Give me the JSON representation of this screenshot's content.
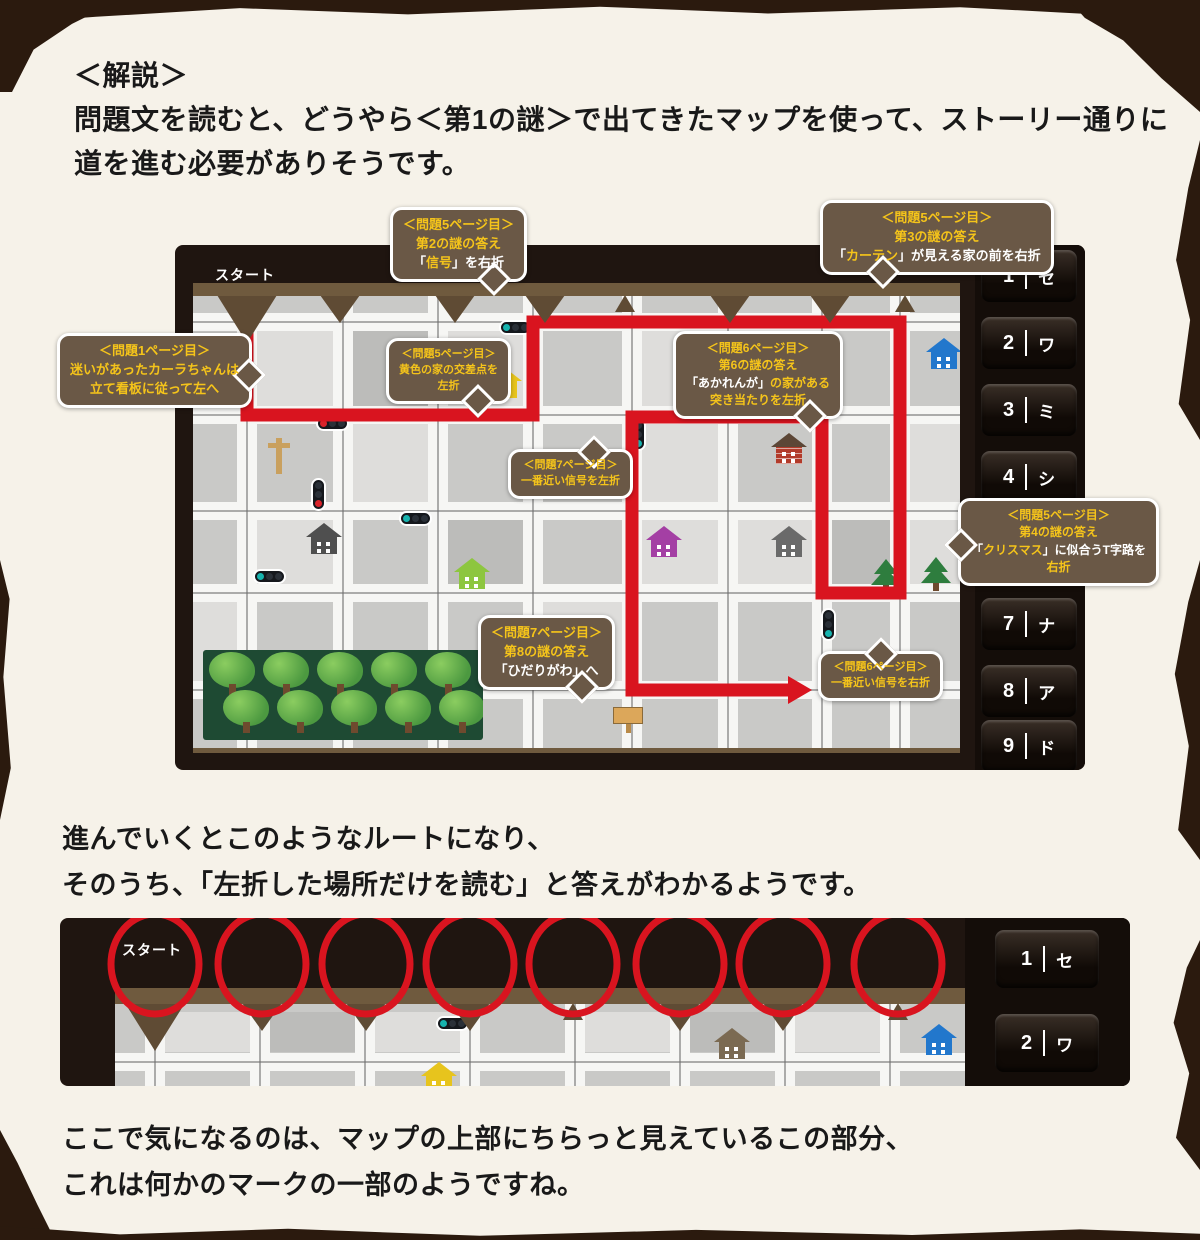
{
  "intro": {
    "heading": "＜解説＞",
    "line1": "問題文を読むと、どうやら＜第1の謎＞で出てきたマップを使って、ストーリー通りに",
    "line2": "道を進む必要がありそうです。"
  },
  "mid": {
    "line1": "進んでいくとこのようなルートになり、",
    "line2": "そのうち、「左折した場所だけを読む」と答えがわかるようです。"
  },
  "outro": {
    "line1": "ここで気になるのは、マップの上部にちらっと見えているこの部分、",
    "line2": "これは何かのマークの一部のようですね。"
  },
  "colors": {
    "accent_red": "#d9141f",
    "bubble_bg": "#6a5846",
    "bubble_yellow": "#f5c41a",
    "paper": "#f6f2e9",
    "frame": "#1f1510",
    "strip": "#6f5a3e",
    "map_base": "#c9c9c7",
    "road": "#f6f6f4",
    "teal": "#17b3ae",
    "signal_red": "#d8232a",
    "signal_off": "#2a3038"
  },
  "map1": {
    "x": 175,
    "y": 245,
    "w": 910,
    "h": 525,
    "inner": {
      "x": 18,
      "y": 51,
      "w": 767,
      "h": 452
    },
    "strip_h": 13,
    "start_label": "スタート",
    "start_pos": [
      40,
      20
    ],
    "notches": [
      {
        "x": 54,
        "t": "vbig"
      },
      {
        "x": 147,
        "t": "v"
      },
      {
        "x": 262,
        "t": "v"
      },
      {
        "x": 352,
        "t": "v"
      },
      {
        "x": 432,
        "t": "a"
      },
      {
        "x": 537,
        "t": "v"
      },
      {
        "x": 637,
        "t": "v"
      },
      {
        "x": 712,
        "t": "a"
      }
    ],
    "grid_x": [
      54,
      150,
      245,
      340,
      439,
      535,
      629,
      707
    ],
    "grid_y": [
      26,
      119,
      215,
      297,
      394
    ],
    "blocks_light": [
      [
        64,
        35,
        76,
        75
      ],
      [
        255,
        35,
        75,
        75
      ],
      [
        449,
        35,
        86,
        75
      ],
      [
        160,
        128,
        75,
        78
      ],
      [
        449,
        128,
        86,
        160
      ],
      [
        64,
        224,
        96,
        64
      ],
      [
        350,
        306,
        79,
        79
      ],
      [
        545,
        224,
        74,
        64
      ],
      [
        717,
        128,
        50,
        160
      ],
      [
        0,
        306,
        44,
        80
      ]
    ],
    "blocks_dark": [
      [
        160,
        35,
        75,
        75
      ],
      [
        639,
        224,
        58,
        64
      ],
      [
        255,
        224,
        75,
        64
      ]
    ],
    "route": {
      "points": [
        [
          54,
          11
        ],
        [
          54,
          119
        ],
        [
          340,
          119
        ],
        [
          340,
          26
        ],
        [
          707,
          26
        ],
        [
          707,
          297
        ],
        [
          629,
          297
        ],
        [
          629,
          121
        ],
        [
          439,
          121
        ],
        [
          439,
          394
        ],
        [
          597,
          394
        ]
      ],
      "width": 13
    },
    "icons": [
      {
        "t": "tlh",
        "x": 320,
        "y": 38,
        "d": [
          "teal",
          "off",
          "off"
        ]
      },
      {
        "t": "tlh",
        "x": 137,
        "y": 134,
        "d": [
          "red",
          "off",
          "off"
        ]
      },
      {
        "t": "tlv",
        "x": 132,
        "y": 196,
        "d": [
          "off",
          "off",
          "red"
        ]
      },
      {
        "t": "tlh",
        "x": 220,
        "y": 229,
        "d": [
          "teal",
          "off",
          "off"
        ]
      },
      {
        "t": "tlh",
        "x": 74,
        "y": 287,
        "d": [
          "teal",
          "off",
          "off"
        ]
      },
      {
        "t": "tlv",
        "x": 452,
        "y": 136,
        "d": [
          "off",
          "off",
          "teal"
        ]
      },
      {
        "t": "tlv",
        "x": 642,
        "y": 326,
        "d": [
          "off",
          "off",
          "teal"
        ]
      },
      {
        "t": "post",
        "x": 97,
        "y": 156
      },
      {
        "t": "house",
        "x": 307,
        "y": 85,
        "c": "#e7c41d"
      },
      {
        "t": "house",
        "x": 127,
        "y": 241,
        "c": "#4f4f4f"
      },
      {
        "t": "house",
        "x": 275,
        "y": 276,
        "c": "#8dc63f"
      },
      {
        "t": "house",
        "x": 467,
        "y": 244,
        "c": "#a43fa4"
      },
      {
        "t": "house",
        "x": 592,
        "y": 244,
        "c": "#6a6a6a"
      },
      {
        "t": "house",
        "x": 592,
        "y": 151,
        "c": "#b23b2a",
        "roof": "#5c4636",
        "brick": true
      },
      {
        "t": "house",
        "x": 747,
        "y": 56,
        "c": "#2277cc"
      },
      {
        "t": "pine",
        "x": 692,
        "y": 277
      },
      {
        "t": "pine",
        "x": 742,
        "y": 275
      },
      {
        "t": "deco",
        "x": 737,
        "y": 376
      },
      {
        "t": "board",
        "x": 434,
        "y": 425
      }
    ],
    "forest": {
      "x": 10,
      "y": 354,
      "w": 280,
      "h": 90
    },
    "keys_panel": {
      "x": 800,
      "w": 110,
      "key_x": 806,
      "key_w": 96,
      "key_h": 52
    },
    "keys": [
      {
        "n": "1",
        "k": "セ",
        "y": 5
      },
      {
        "n": "2",
        "k": "ワ",
        "y": 72
      },
      {
        "n": "3",
        "k": "ミ",
        "y": 139
      },
      {
        "n": "4",
        "k": "シ",
        "y": 206
      },
      {
        "n": "7",
        "k": "ナ",
        "y": 353
      },
      {
        "n": "8",
        "k": "ア",
        "y": 420
      },
      {
        "n": "9",
        "k": "ド",
        "y": 475
      }
    ]
  },
  "map2": {
    "x": 60,
    "y": 918,
    "w": 1070,
    "h": 168,
    "inner": {
      "x": 55,
      "y": 86,
      "w": 850,
      "h": 82
    },
    "strip_h": 16,
    "start_label": "スタート",
    "start_pos": [
      62,
      22
    ],
    "notches": [
      {
        "x": 40,
        "t": "vbig"
      },
      {
        "x": 147,
        "t": "v"
      },
      {
        "x": 251,
        "t": "v"
      },
      {
        "x": 355,
        "t": "v"
      },
      {
        "x": 458,
        "t": "a"
      },
      {
        "x": 565,
        "t": "v"
      },
      {
        "x": 668,
        "t": "v"
      },
      {
        "x": 783,
        "t": "a"
      }
    ],
    "grid_x": [
      40,
      145,
      250,
      355,
      460,
      565,
      670,
      775
    ],
    "grid_y": [
      58
    ],
    "blocks_light": [
      [
        50,
        8,
        85,
        40
      ],
      [
        260,
        8,
        85,
        40
      ],
      [
        470,
        8,
        85,
        40
      ],
      [
        680,
        8,
        85,
        40
      ]
    ],
    "blocks_dark": [
      [
        155,
        8,
        85,
        40
      ],
      [
        575,
        8,
        85,
        40
      ]
    ],
    "circles": {
      "cx": [
        95,
        202,
        306,
        410,
        513,
        620,
        723,
        838
      ],
      "cy": 46,
      "rx": 44,
      "ry": 50
    },
    "icons": [
      {
        "t": "tlh",
        "x": 335,
        "y": 26,
        "d": [
          "teal",
          "off",
          "off"
        ]
      },
      {
        "t": "house",
        "x": 613,
        "y": 38,
        "c": "#7b6a52"
      },
      {
        "t": "house",
        "x": 820,
        "y": 34,
        "c": "#2277cc"
      },
      {
        "t": "house",
        "x": 320,
        "y": 72,
        "c": "#e7c41d"
      }
    ],
    "keys_panel": {
      "x": 905,
      "w": 165,
      "key_x": 935,
      "key_w": 104,
      "key_h": 58
    },
    "keys": [
      {
        "n": "1",
        "k": "セ",
        "y": 12
      },
      {
        "n": "2",
        "k": "ワ",
        "y": 96
      }
    ]
  },
  "bubbles": [
    {
      "x": 390,
      "y": 207,
      "fs": 13,
      "tail": "t-br",
      "lines": [
        [
          {
            "t": "＜問題5ページ目＞",
            "c": "y"
          }
        ],
        [
          {
            "t": "第2の謎の答え",
            "c": "y"
          }
        ],
        [
          {
            "t": "「",
            "c": "w"
          },
          {
            "t": "信号",
            "c": "y"
          },
          {
            "t": "」を右折",
            "c": "w"
          }
        ]
      ]
    },
    {
      "x": 820,
      "y": 200,
      "fs": 13,
      "tail": "t-bl",
      "lines": [
        [
          {
            "t": "＜問題5ページ目＞",
            "c": "y"
          }
        ],
        [
          {
            "t": "第3の謎の答え",
            "c": "y"
          }
        ],
        [
          {
            "t": "「",
            "c": "w"
          },
          {
            "t": "カーテン",
            "c": "y"
          },
          {
            "t": "」が見える家の前を右折",
            "c": "w"
          }
        ]
      ]
    },
    {
      "x": 57,
      "y": 333,
      "fs": 13,
      "tail": "t-r",
      "lines": [
        [
          {
            "t": "＜問題1ページ目＞",
            "c": "y"
          }
        ],
        [
          {
            "t": "迷いがあったカーラちゃんは",
            "c": "y"
          }
        ],
        [
          {
            "t": "立て看板に従って左へ",
            "c": "y"
          }
        ]
      ]
    },
    {
      "x": 386,
      "y": 338,
      "fs": 11,
      "tail": "t-br",
      "lines": [
        [
          {
            "t": "＜問題5ページ目＞",
            "c": "y"
          }
        ],
        [
          {
            "t": "黄色の家の交差点を",
            "c": "y"
          }
        ],
        [
          {
            "t": "左折",
            "c": "y"
          }
        ]
      ]
    },
    {
      "x": 673,
      "y": 331,
      "fs": 12,
      "tail": "t-br",
      "lines": [
        [
          {
            "t": "＜問題6ページ目＞",
            "c": "y"
          }
        ],
        [
          {
            "t": "第6の謎の答え",
            "c": "y"
          }
        ],
        [
          {
            "t": "「あかれんが」",
            "c": "w"
          },
          {
            "t": "の家がある",
            "c": "y"
          }
        ],
        [
          {
            "t": "突き当たりを左折",
            "c": "y"
          }
        ]
      ]
    },
    {
      "x": 508,
      "y": 449,
      "fs": 11,
      "tail": "t-tr",
      "lines": [
        [
          {
            "t": "＜問題7ページ目＞",
            "c": "y"
          }
        ],
        [
          {
            "t": "一番近い信号を左折",
            "c": "y"
          }
        ]
      ]
    },
    {
      "x": 958,
      "y": 498,
      "fs": 12,
      "tail": "t-lb",
      "lines": [
        [
          {
            "t": "＜問題5ページ目＞",
            "c": "y"
          }
        ],
        [
          {
            "t": "第4の謎の答え",
            "c": "y"
          }
        ],
        [
          {
            "t": "「",
            "c": "w"
          },
          {
            "t": "クリスマス",
            "c": "y"
          },
          {
            "t": "」に似合うT字路を",
            "c": "w"
          }
        ],
        [
          {
            "t": "右折",
            "c": "y"
          }
        ]
      ]
    },
    {
      "x": 478,
      "y": 615,
      "fs": 13,
      "tail": "t-br",
      "lines": [
        [
          {
            "t": "＜問題7ページ目＞",
            "c": "y"
          }
        ],
        [
          {
            "t": "第8の謎の答え",
            "c": "y"
          }
        ],
        [
          {
            "t": "「ひだりがわ」へ",
            "c": "w"
          }
        ]
      ]
    },
    {
      "x": 818,
      "y": 651,
      "fs": 11,
      "tail": "t-tc",
      "lines": [
        [
          {
            "t": "＜問題6ページ目＞",
            "c": "y"
          }
        ],
        [
          {
            "t": "一番近い信号を右折",
            "c": "y"
          }
        ]
      ]
    }
  ]
}
